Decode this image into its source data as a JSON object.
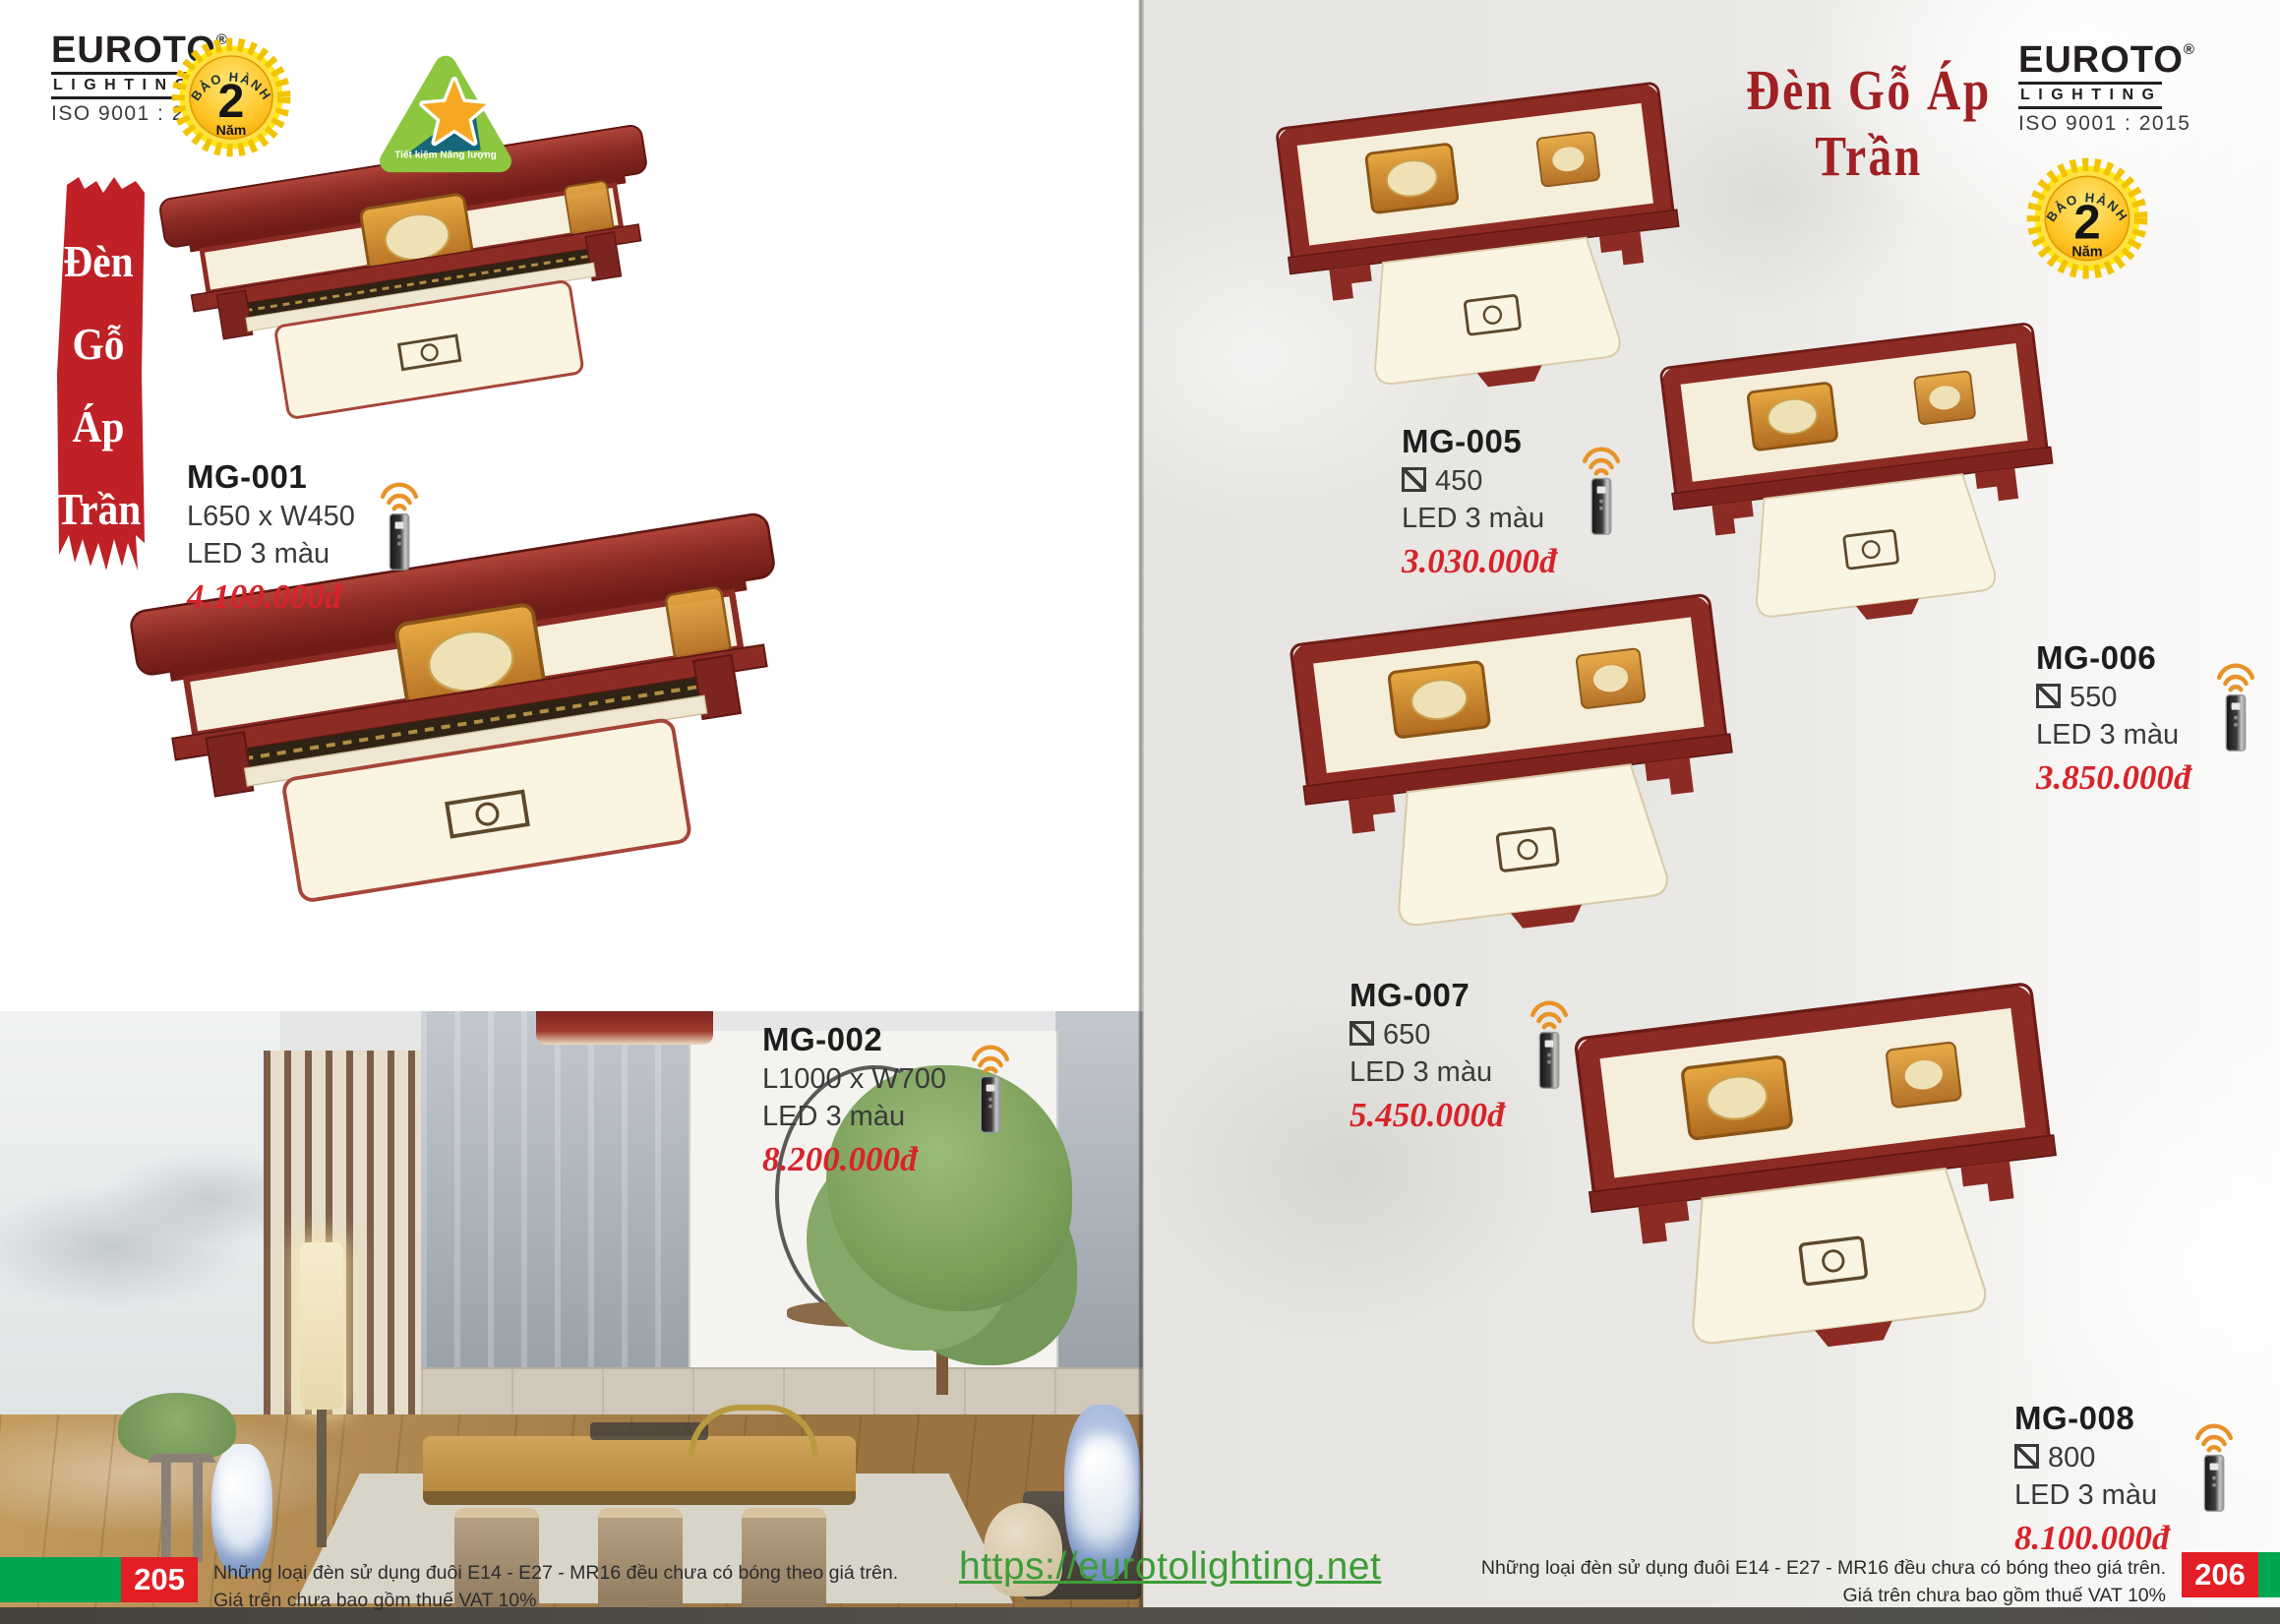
{
  "brand": {
    "name": "EUROTO",
    "reg": "®",
    "tagline": "LIGHTING",
    "iso": "ISO 9001 : 2015"
  },
  "badges": {
    "warranty_arc": "BẢO HÀNH",
    "warranty_number": "2",
    "warranty_unit": "Năm",
    "eco_label": "Tiết kiệm Năng lượng"
  },
  "left_banner": {
    "lines": [
      "Đèn",
      "Gỗ",
      "Áp",
      "Trần"
    ]
  },
  "right_page_title": "Đèn Gỗ Áp Trần",
  "products": [
    {
      "code": "MG-001",
      "size": "L650 x W450",
      "led": "LED 3 màu",
      "price": "4.100.000đ",
      "shape": "rect"
    },
    {
      "code": "MG-002",
      "size": "L1000 x W700",
      "led": "LED 3 màu",
      "price": "8.200.000đ",
      "shape": "rect"
    },
    {
      "code": "MG-005",
      "size": "450",
      "led": "LED 3 màu",
      "price": "3.030.000đ",
      "shape": "square"
    },
    {
      "code": "MG-006",
      "size": "550",
      "led": "LED 3 màu",
      "price": "3.850.000đ",
      "shape": "square"
    },
    {
      "code": "MG-007",
      "size": "650",
      "led": "LED 3 màu",
      "price": "5.450.000đ",
      "shape": "square"
    },
    {
      "code": "MG-008",
      "size": "800",
      "led": "LED 3 màu",
      "price": "8.100.000đ",
      "shape": "square"
    }
  ],
  "footer": {
    "note_line1": "Những loại đèn sử dụng đuôi E14 - E27 - MR16 đều chưa có bóng theo giá trên.",
    "note_line2": "Giá trên chưa bao gồm thuế VAT 10%",
    "left_page_number": "205",
    "right_page_number": "206",
    "website": "https://eurotolighting.net"
  },
  "colors": {
    "price_red": "#d7232a",
    "title_red": "#a02023",
    "banner_red": "#bf2126",
    "wood_red": "#8c2b24",
    "footer_green": "#00a651",
    "page_badge_red": "#e31e25",
    "website_green": "#3e9c39",
    "badge_yellow": "#ffe619",
    "eco_green": "#8dc63f"
  }
}
